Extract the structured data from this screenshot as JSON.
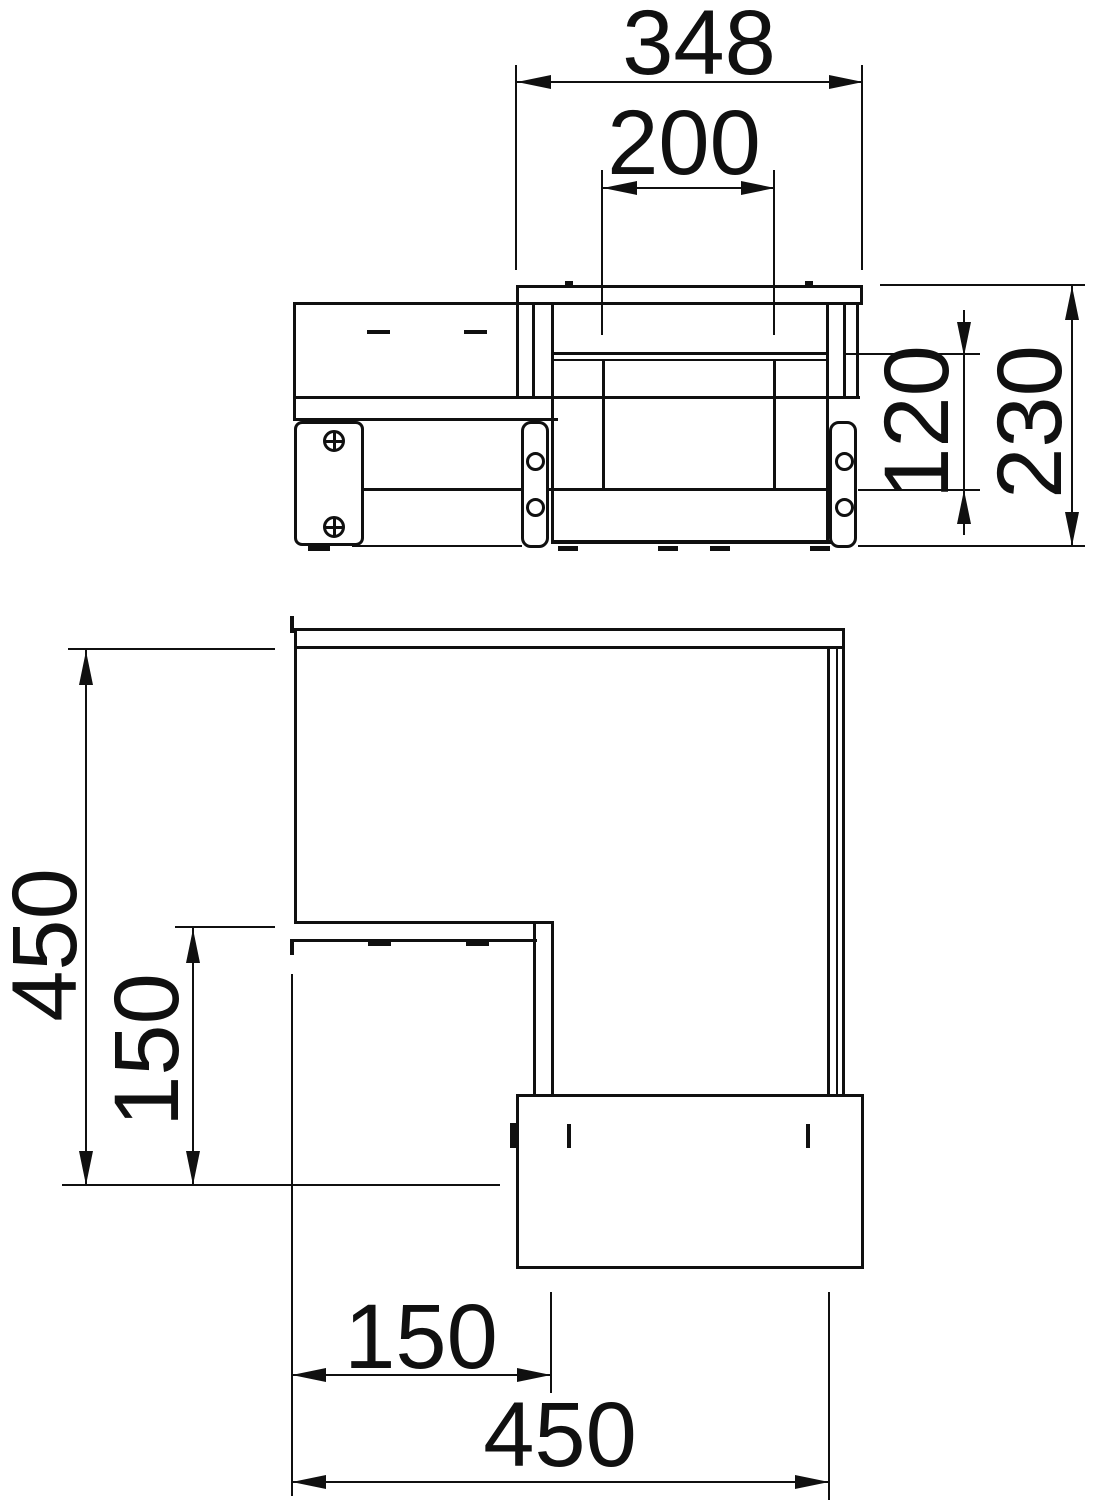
{
  "dimensions": {
    "front_overall_width": "348",
    "front_inner_width": "200",
    "front_frame_height": "120",
    "front_overall_height": "230",
    "plan_overall_depth": "450",
    "plan_inner_depth": "150",
    "plan_front_offset": "150",
    "plan_overall_width": "450"
  }
}
